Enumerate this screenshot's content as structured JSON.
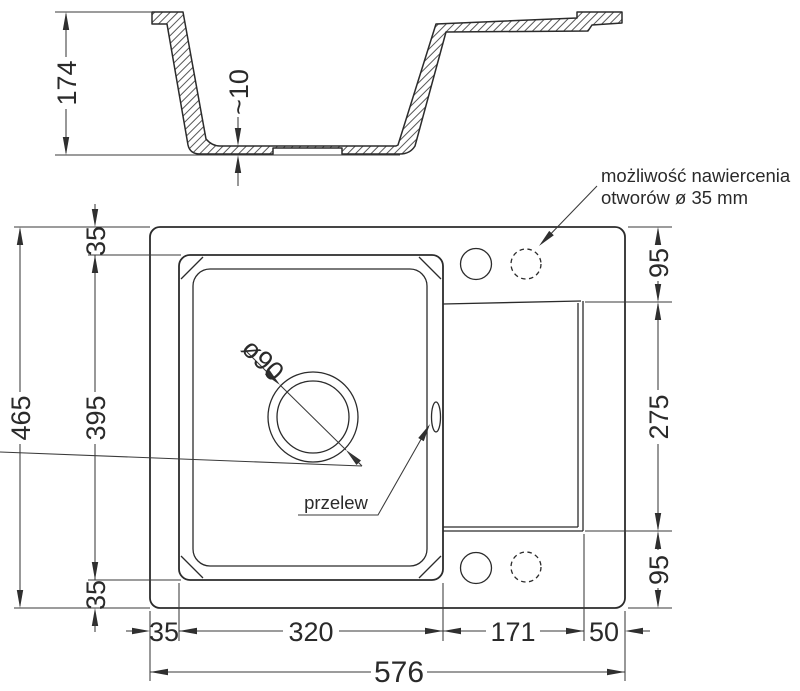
{
  "section": {
    "height": "174",
    "bottom_thickness": "~10"
  },
  "plan": {
    "total_height": "465",
    "total_width": "576",
    "margin_top": "35",
    "bowl_length": "395",
    "margin_bottom": "35",
    "deck_top": "95",
    "drainer_length": "275",
    "deck_bottom": "95",
    "margin_left": "35",
    "bowl_width": "320",
    "drainer_width": "171",
    "margin_right": "50",
    "drain_diameter": "ø90",
    "overflow_label": "przelew",
    "drill_note_1": "możliwość nawiercenia",
    "drill_note_2": "otworów ø 35 mm"
  },
  "colors": {
    "line": "#2b2b2b",
    "background": "#ffffff"
  }
}
